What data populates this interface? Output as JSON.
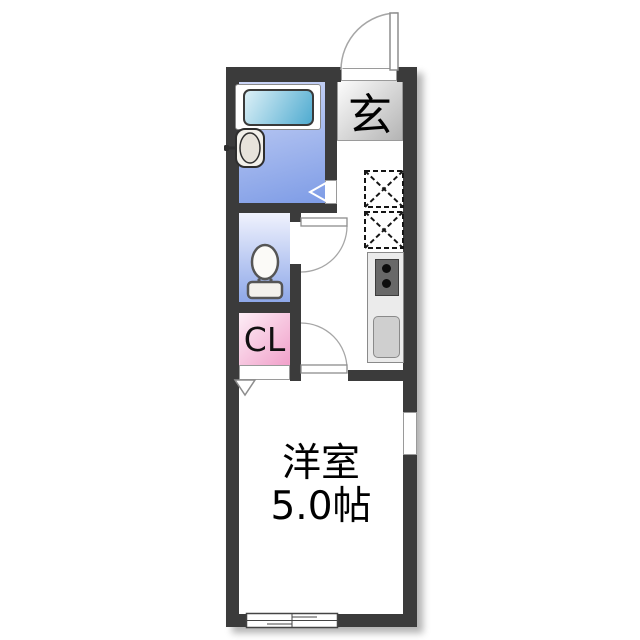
{
  "plan": {
    "type": "japanese-apartment-floorplan",
    "labels": {
      "entrance": "玄",
      "closet": "CL",
      "room_name": "洋室",
      "room_size": "5.0帖"
    },
    "rooms": [
      {
        "name": "entrance-genkan",
        "label": "玄"
      },
      {
        "name": "bathroom",
        "label": ""
      },
      {
        "name": "toilet-room",
        "label": ""
      },
      {
        "name": "closet",
        "label": "CL"
      },
      {
        "name": "kitchen-hallway",
        "label": ""
      },
      {
        "name": "western-room",
        "label": "洋室 5.0帖"
      }
    ],
    "fixtures": [
      "bathtub",
      "washbasin",
      "toilet",
      "stove-two-burners",
      "kitchen-sink",
      "appliance-space-dashed-x",
      "appliance-space-dashed-x",
      "entrance-swing-door",
      "toilet-swing-door",
      "room-swing-door",
      "bathroom-door-arrow",
      "closet-door-arrow",
      "sliding-window-bottom",
      "window-right"
    ],
    "colors": {
      "wall": "#3b3b3b",
      "bathroom_floor_gradient": [
        "#ccd6f6",
        "#7e9ce6"
      ],
      "bathtub_gradient": [
        "#dcf0f7",
        "#4fabd0"
      ],
      "toilet_floor_gradient": [
        "#f0f2fd",
        "#8ea8e9"
      ],
      "closet_gradient": [
        "#fdeef6",
        "#f1a0ca"
      ],
      "entrance_gradient": [
        "#fcfcfc",
        "#b4b4b4"
      ],
      "kitchen_counter": "#ebebeb",
      "stove": "#686868",
      "sink": "#cfcfcf",
      "background": "#ffffff"
    }
  }
}
